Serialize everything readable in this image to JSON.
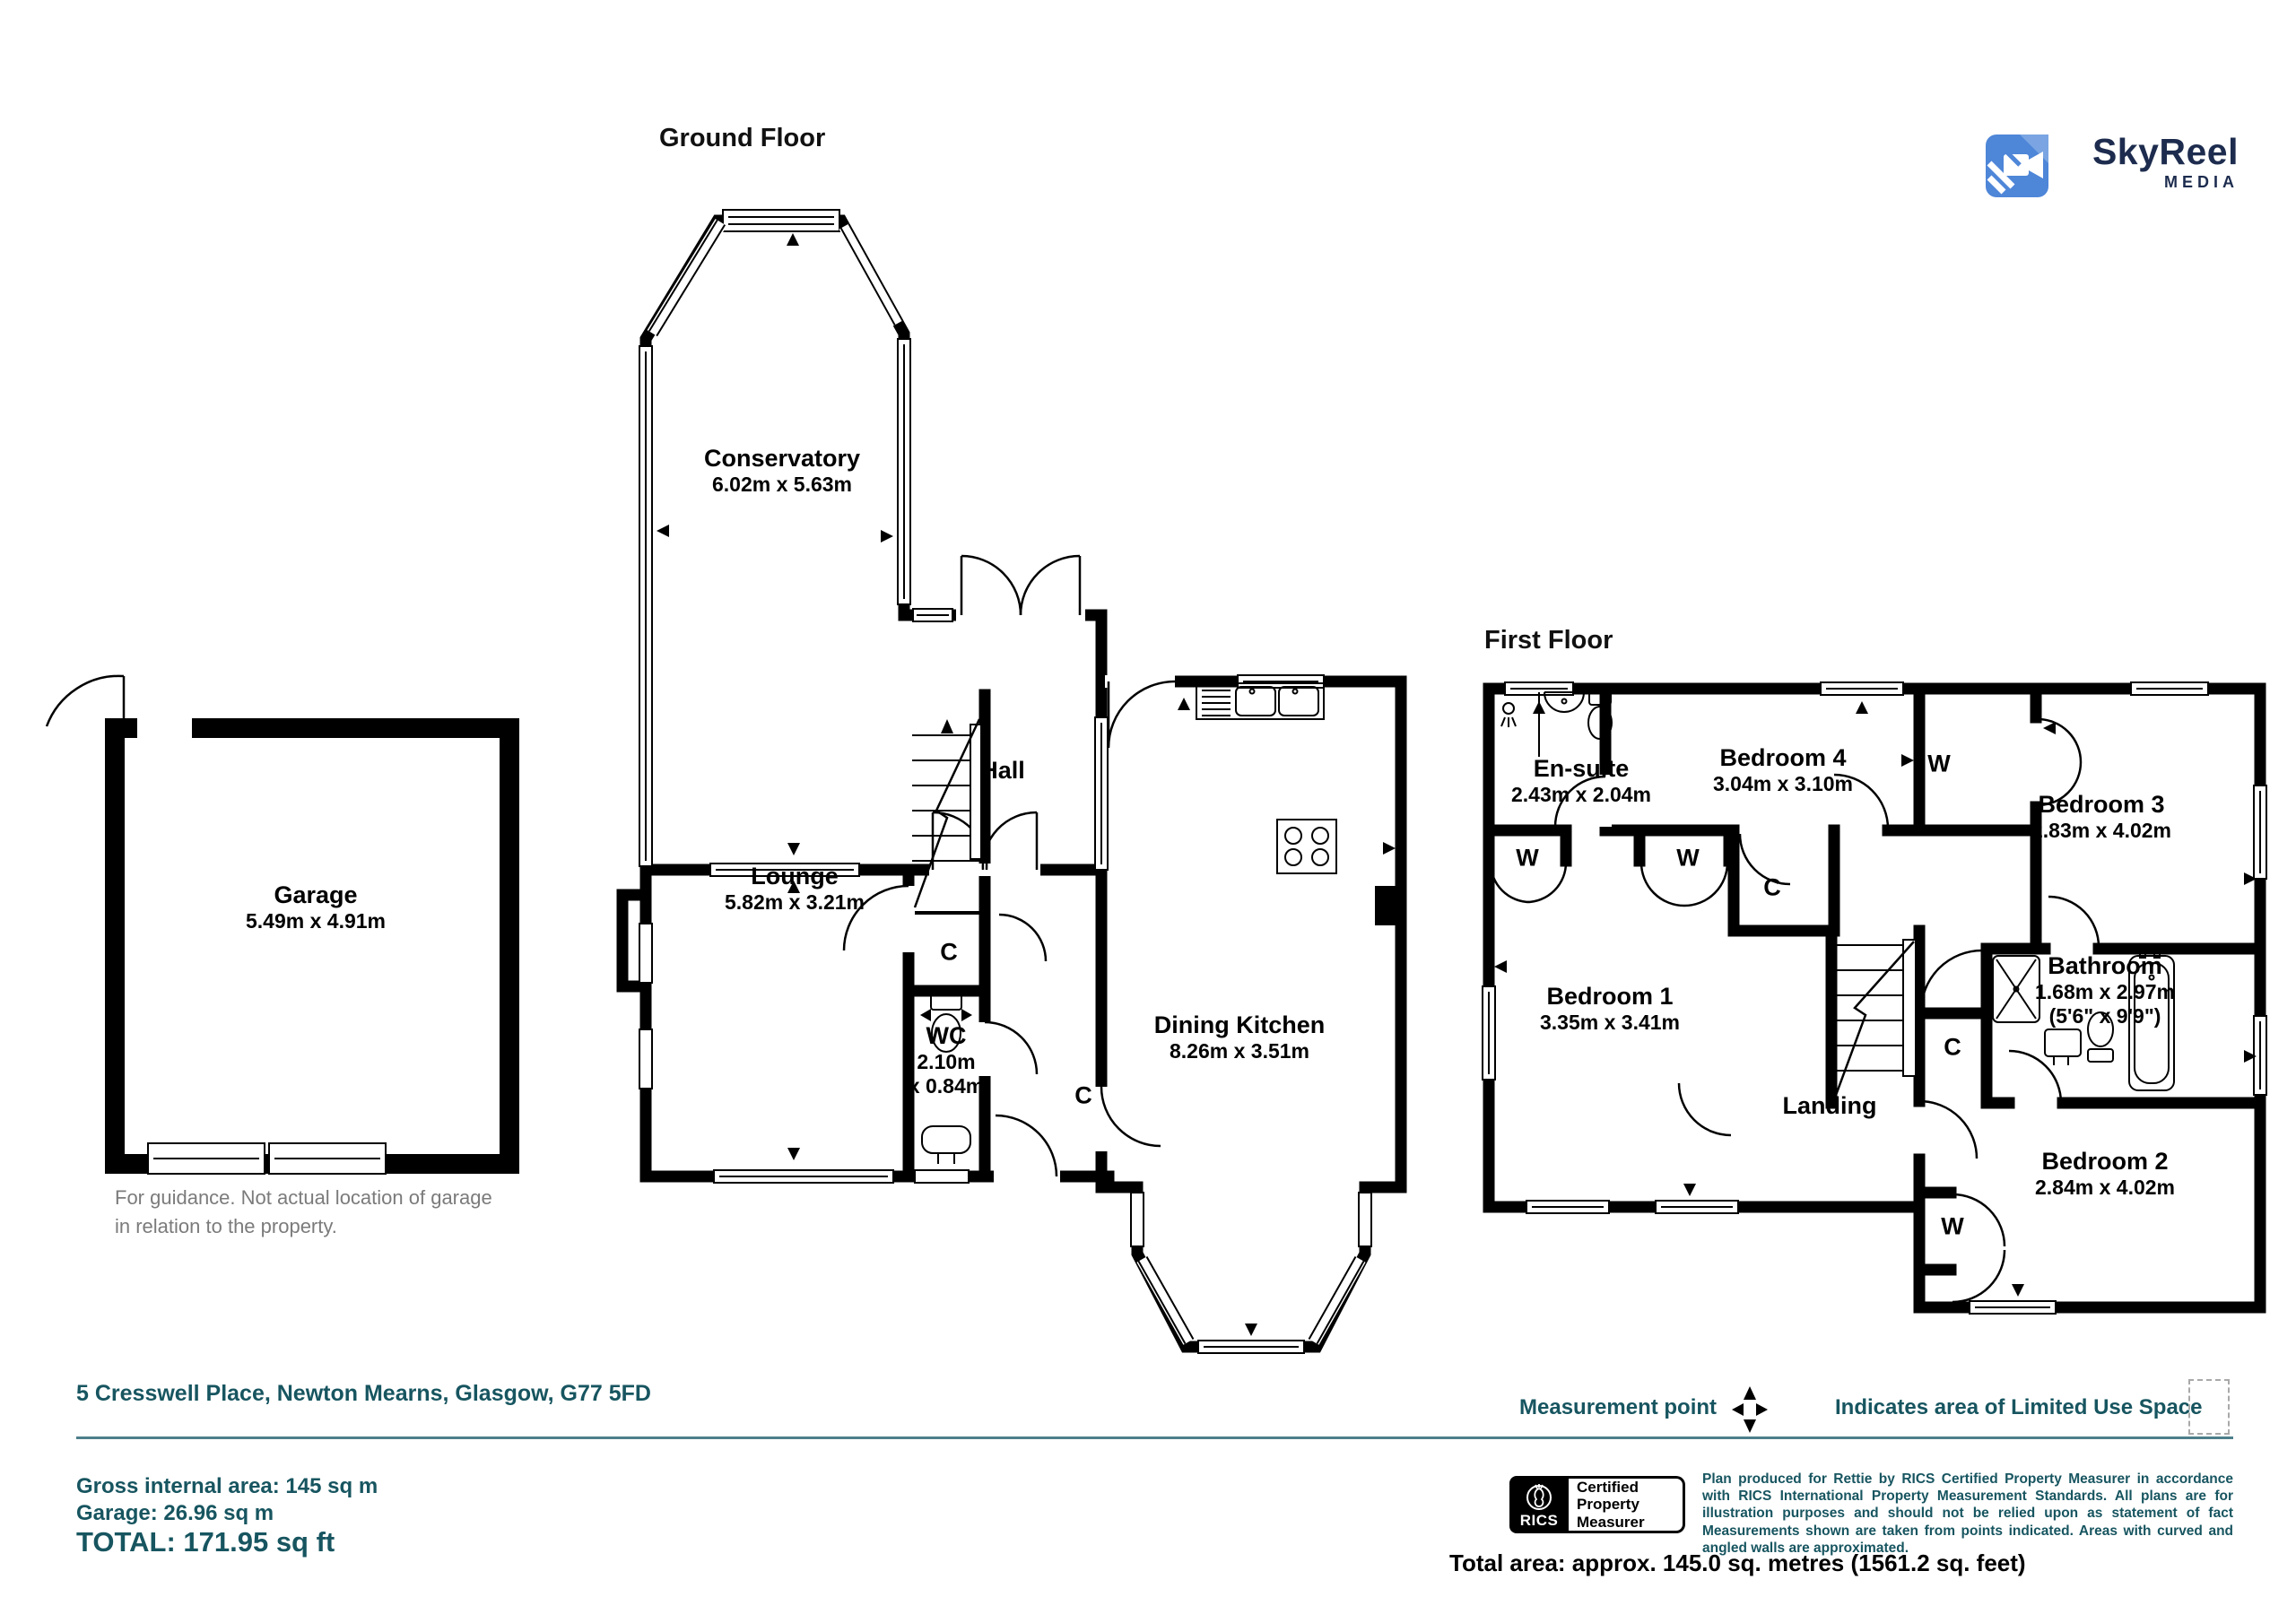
{
  "titles": {
    "ground_floor": "Ground Floor",
    "first_floor": "First Floor"
  },
  "logo": {
    "name": "SkyReel",
    "tagline": "MEDIA"
  },
  "letters": {
    "wardrobe": "W",
    "cupboard": "C"
  },
  "ground_floor": {
    "conservatory": {
      "name": "Conservatory",
      "dims": "6.02m x 5.63m"
    },
    "lounge": {
      "name": "Lounge",
      "dims": "5.82m x 3.21m"
    },
    "hall": {
      "name": "Hall"
    },
    "wc": {
      "name": "WC",
      "dims": "2.10m\nx 0.84m"
    },
    "dining_kitchen": {
      "name": "Dining Kitchen",
      "dims": "8.26m x 3.51m"
    }
  },
  "garage": {
    "name": "Garage",
    "dims": "5.49m x 4.91m",
    "note": "For guidance. Not actual location of garage\nin relation to the property."
  },
  "first_floor": {
    "ensuite": {
      "name": "En-suite",
      "dims": "2.43m x 2.04m"
    },
    "bedroom4": {
      "name": "Bedroom 4",
      "dims": "3.04m x 3.10m"
    },
    "bedroom3": {
      "name": "Bedroom 3",
      "dims": "2.83m x 4.02m"
    },
    "bedroom1": {
      "name": "Bedroom 1",
      "dims": "3.35m x 3.41m"
    },
    "bathroom": {
      "name": "Bathroom",
      "dims": "1.68m x 2.97m",
      "dims_imperial": "(5'6\" x 9'9\")"
    },
    "bedroom2": {
      "name": "Bedroom 2",
      "dims": "2.84m x 4.02m"
    },
    "landing": {
      "name": "Landing"
    }
  },
  "footer": {
    "address": "5 Cresswell Place, Newton Mearns, Glasgow, G77 5FD",
    "measurement_point": "Measurement point",
    "limited_use": "Indicates area of Limited Use Space",
    "gross_area": "Gross internal area: 145 sq m",
    "garage_area": "Garage: 26.96 sq m",
    "total": "TOTAL: 171.95 sq ft",
    "total_area": "Total area: approx. 145.0 sq. metres (1561.2 sq. feet)",
    "disclaimer": "Plan produced for Rettie by RICS Certified Property Measurer in accordance with RICS International Property  Measurement Standards.  All plans are for illustration purposes and should not be relied upon as statement of fact Measurements shown are taken from points indicated. Areas with curved and angled walls are approximated.",
    "rics": {
      "org": "RICS",
      "label": "Certified\nProperty\nMeasurer"
    }
  },
  "colors": {
    "accent": "#175560",
    "logo_blue": "#4e86d8",
    "logo_navy": "#1d2c4e",
    "note_gray": "#7b7b7b"
  }
}
